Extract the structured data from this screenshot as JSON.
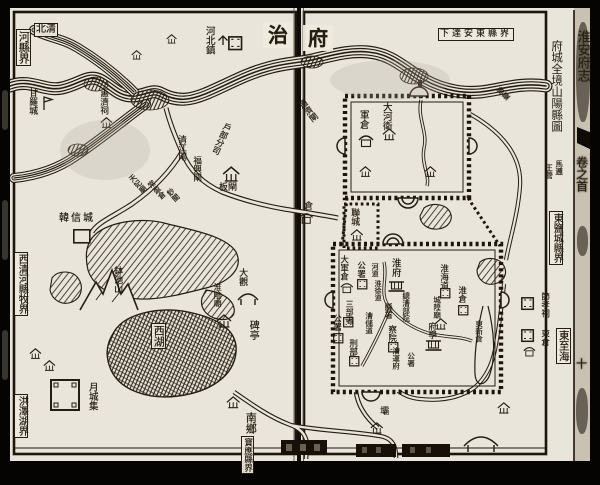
{
  "book": {
    "title": "淮安府志",
    "volume": "卷之首",
    "page_mark": "十"
  },
  "map": {
    "title": "府城全境山陽縣圖",
    "prefecture_seat": {
      "right_page_char": "府",
      "left_page_char": "治"
    },
    "labels": [
      {
        "t": "北清",
        "x": 34,
        "y": 23,
        "o": "h",
        "fs": 10,
        "box": 1,
        "name": "border-north-label-top"
      },
      {
        "t": "河縣界",
        "x": 16,
        "y": 29,
        "o": "v",
        "fs": 11,
        "box": 1,
        "name": "border-north-label"
      },
      {
        "t": "甘羅城",
        "x": 27,
        "y": 88,
        "o": "v",
        "fs": 9,
        "name": "ganluocheng-label"
      },
      {
        "t": "惠濟祠",
        "x": 99,
        "y": 89,
        "o": "v",
        "fs": 8.5,
        "name": "huijici-label"
      },
      {
        "t": "河北鎮",
        "x": 204,
        "y": 26,
        "o": "v",
        "fs": 9.5,
        "name": "hebeizhen-label"
      },
      {
        "t": "治",
        "x": 263,
        "y": 22,
        "o": "h",
        "fs": 20,
        "seat": 1,
        "name": "seat-zhi-label"
      },
      {
        "t": "府",
        "x": 303,
        "y": 25,
        "o": "h",
        "fs": 20,
        "seat": 1,
        "name": "seat-fu-label"
      },
      {
        "t": "下達安東縣界",
        "x": 438,
        "y": 28,
        "o": "h",
        "fs": 9,
        "box": 1,
        "ls": 3,
        "name": "andong-border-label"
      },
      {
        "t": "通濟閘",
        "x": 296,
        "y": 104,
        "o": "v",
        "fs": 8.5,
        "rot": -38,
        "name": "tongjizha-label"
      },
      {
        "t": "清江閘",
        "x": 177,
        "y": 135,
        "o": "v",
        "fs": 8.5,
        "name": "qingjiangzha-label"
      },
      {
        "t": "福興閘",
        "x": 192,
        "y": 156,
        "o": "v",
        "fs": 8.5,
        "name": "fuxingzha-label"
      },
      {
        "t": "戶部分司",
        "x": 224,
        "y": 121,
        "o": "v",
        "fs": 8.5,
        "rot": 25,
        "name": "hubu-fensi-label"
      },
      {
        "t": "板閘",
        "x": 219,
        "y": 184,
        "o": "h",
        "fs": 9,
        "name": "banzha-label"
      },
      {
        "t": "天妃廟",
        "x": 127,
        "y": 178,
        "o": "v",
        "fs": 7.5,
        "rot": -42,
        "name": "tianfeimiao-label"
      },
      {
        "t": "常盈倉",
        "x": 146,
        "y": 184,
        "o": "v",
        "fs": 7.5,
        "rot": -42,
        "name": "changyingcang-label"
      },
      {
        "t": "鈔關",
        "x": 165,
        "y": 192,
        "o": "v",
        "fs": 7.5,
        "rot": -42,
        "name": "chaoguan-label"
      },
      {
        "t": "韓信城",
        "x": 59,
        "y": 214,
        "o": "h",
        "fs": 10,
        "ls": 2,
        "name": "hanxincheng-label"
      },
      {
        "t": "鉢池山",
        "x": 112,
        "y": 266,
        "o": "v",
        "fs": 9,
        "name": "bochishan-label"
      },
      {
        "t": "淮陰廟",
        "x": 213,
        "y": 283,
        "o": "v",
        "fs": 8,
        "name": "huaiyinmiao-label"
      },
      {
        "t": "大觀",
        "x": 237,
        "y": 268,
        "o": "v",
        "fs": 9,
        "name": "daguan-label"
      },
      {
        "t": "碑亭",
        "x": 247,
        "y": 320,
        "o": "v",
        "fs": 10,
        "name": "beiting-label"
      },
      {
        "t": "西湖",
        "x": 151,
        "y": 323,
        "o": "v",
        "fs": 11,
        "box": 1,
        "name": "xihu-label"
      },
      {
        "t": "南鄉",
        "x": 245,
        "y": 412,
        "o": "v",
        "fs": 11,
        "name": "nanxiang-label"
      },
      {
        "t": "月城集",
        "x": 87,
        "y": 382,
        "o": "v",
        "fs": 9.5,
        "name": "yuechengji-label"
      },
      {
        "t": "寶應縣界",
        "x": 241,
        "y": 436,
        "o": "v",
        "fs": 8.5,
        "box": 1,
        "name": "baoying-border-label"
      },
      {
        "t": "西清河縣牧界",
        "x": 14,
        "y": 252,
        "o": "v",
        "fs": 10,
        "box": 1,
        "name": "border-west-label"
      },
      {
        "t": "洪澤湖界",
        "x": 14,
        "y": 394,
        "o": "v",
        "fs": 10,
        "box": 1,
        "name": "border-southwest-label"
      },
      {
        "t": "墩臺",
        "x": 495,
        "y": 91,
        "o": "v",
        "fs": 7.5,
        "rot": -45,
        "name": "duntai-label"
      },
      {
        "t": "王營",
        "x": 545,
        "y": 164,
        "o": "v",
        "fs": 7.5,
        "name": "wangying-label"
      },
      {
        "t": "馬邏",
        "x": 555,
        "y": 160,
        "o": "v",
        "fs": 7.5,
        "name": "maluo-label"
      },
      {
        "t": "軍倉",
        "x": 358,
        "y": 110,
        "o": "v",
        "fs": 9.5,
        "name": "juncang-label"
      },
      {
        "t": "大河衛",
        "x": 381,
        "y": 102,
        "o": "v",
        "fs": 9.5,
        "name": "dahewei-label"
      },
      {
        "t": "聯城",
        "x": 349,
        "y": 208,
        "o": "v",
        "fs": 9,
        "name": "liancheng-label"
      },
      {
        "t": "倉",
        "x": 302,
        "y": 201,
        "o": "v",
        "fs": 9,
        "name": "west-cang-label"
      },
      {
        "t": "淮府",
        "x": 390,
        "y": 258,
        "o": "v",
        "fs": 9.5,
        "name": "huaifu-label"
      },
      {
        "t": "大軍倉",
        "x": 339,
        "y": 255,
        "o": "v",
        "fs": 8.5,
        "name": "dajuncang-label"
      },
      {
        "t": "公署",
        "x": 356,
        "y": 261,
        "o": "v",
        "fs": 8.5,
        "name": "gongshu-label-1"
      },
      {
        "t": "河道",
        "x": 371,
        "y": 263,
        "o": "v",
        "fs": 7,
        "name": "hedao-label"
      },
      {
        "t": "淮徐道",
        "x": 374,
        "y": 280,
        "o": "v",
        "fs": 7,
        "name": "huaixudao-label"
      },
      {
        "t": "三部署",
        "x": 345,
        "y": 300,
        "o": "v",
        "fs": 8,
        "name": "sanbushu-label"
      },
      {
        "t": "公署",
        "x": 332,
        "y": 314,
        "o": "v",
        "fs": 8.5,
        "name": "gongshu-label-2"
      },
      {
        "t": "漕儲道",
        "x": 365,
        "y": 312,
        "o": "v",
        "fs": 7.5,
        "name": "caochudao-label"
      },
      {
        "t": "刑部",
        "x": 348,
        "y": 339,
        "o": "v",
        "fs": 8.5,
        "name": "xingbu-label"
      },
      {
        "t": "縣署",
        "x": 384,
        "y": 303,
        "o": "v",
        "fs": 8,
        "name": "xianshu-label"
      },
      {
        "t": "總漕部院",
        "x": 402,
        "y": 292,
        "o": "v",
        "fs": 7.5,
        "name": "zongcao-buyuan-label"
      },
      {
        "t": "察院",
        "x": 387,
        "y": 325,
        "o": "v",
        "fs": 8.5,
        "name": "chayuan-label"
      },
      {
        "t": "漕運府",
        "x": 392,
        "y": 347,
        "o": "v",
        "fs": 7.5,
        "name": "caoyunfu-label"
      },
      {
        "t": "公署",
        "x": 407,
        "y": 352,
        "o": "v",
        "fs": 7.5,
        "name": "gongshu-label-3"
      },
      {
        "t": "淮海道",
        "x": 439,
        "y": 264,
        "o": "v",
        "fs": 8.5,
        "name": "huaihaidao-label"
      },
      {
        "t": "城隍廟",
        "x": 433,
        "y": 296,
        "o": "v",
        "fs": 7.5,
        "name": "chenghuangmiao-label"
      },
      {
        "t": "淮倉",
        "x": 457,
        "y": 286,
        "o": "v",
        "fs": 8.5,
        "name": "huaicang-label"
      },
      {
        "t": "東新倉",
        "x": 475,
        "y": 320,
        "o": "v",
        "fs": 7.5,
        "name": "dongxincang-label"
      },
      {
        "t": "府學",
        "x": 427,
        "y": 322,
        "o": "v",
        "fs": 8.5,
        "name": "fuxue-label"
      },
      {
        "t": "節孝祠",
        "x": 540,
        "y": 292,
        "o": "v",
        "fs": 8.5,
        "name": "jiexiaoci-label"
      },
      {
        "t": "東倉",
        "x": 540,
        "y": 329,
        "o": "v",
        "fs": 8.5,
        "name": "dongcang-label"
      },
      {
        "t": "東至海",
        "x": 556,
        "y": 328,
        "o": "v",
        "fs": 10.5,
        "box": 1,
        "name": "east-to-sea-label"
      },
      {
        "t": "東鹽城縣界",
        "x": 549,
        "y": 211,
        "o": "v",
        "fs": 10,
        "box": 1,
        "name": "border-east-label"
      },
      {
        "t": "壩",
        "x": 378,
        "y": 406,
        "o": "v",
        "fs": 9,
        "name": "ba-label"
      }
    ],
    "icons": [
      {
        "type": "flag",
        "x": 42,
        "y": 95,
        "name": "ganluocheng-flag-icon"
      },
      {
        "type": "house",
        "x": 100,
        "y": 117,
        "s": 0.8,
        "name": "huijici-house-icon"
      },
      {
        "type": "tree",
        "x": 217,
        "y": 32,
        "name": "hebeizhen-tree-icon"
      },
      {
        "type": "box",
        "x": 228,
        "y": 36,
        "s": 1.1,
        "name": "hebeizhen-box-icon"
      },
      {
        "type": "house",
        "x": 166,
        "y": 34,
        "s": 0.7,
        "name": "river-north-house-icon"
      },
      {
        "type": "house",
        "x": 131,
        "y": 50,
        "s": 0.7,
        "name": "river-north-house-icon-2"
      },
      {
        "type": "house",
        "x": 222,
        "y": 166,
        "s": 1.15,
        "name": "hubu-fensi-office-icon"
      },
      {
        "type": "sq",
        "x": 73,
        "y": 229,
        "name": "hanxincheng-square-icon"
      },
      {
        "type": "house",
        "x": 216,
        "y": 314,
        "name": "huaiyinmiao-temple-icon"
      },
      {
        "type": "bigbox",
        "x": 50,
        "y": 379,
        "name": "yuechengji-fort-icon"
      },
      {
        "type": "house",
        "x": 226,
        "y": 396,
        "s": 0.9,
        "name": "nanxiang-house-icon"
      },
      {
        "type": "gran",
        "x": 358,
        "y": 134,
        "name": "juncang-granary-icon"
      },
      {
        "type": "house",
        "x": 382,
        "y": 128,
        "s": 0.9,
        "name": "dahewei-house-icon"
      },
      {
        "type": "house",
        "x": 359,
        "y": 166,
        "s": 0.8,
        "name": "xincheng-house-icon"
      },
      {
        "type": "house",
        "x": 424,
        "y": 166,
        "s": 0.8,
        "name": "xincheng-house-icon-2"
      },
      {
        "type": "house",
        "x": 350,
        "y": 229,
        "s": 0.85,
        "name": "liancheng-house-icon"
      },
      {
        "type": "gran",
        "x": 299,
        "y": 212,
        "s": 0.9,
        "name": "west-granary-icon"
      },
      {
        "type": "yamen",
        "x": 389,
        "y": 280,
        "name": "huaifu-yamen-icon"
      },
      {
        "type": "gran",
        "x": 340,
        "y": 282,
        "s": 0.85,
        "name": "dajuncang-granary-icon"
      },
      {
        "type": "box",
        "x": 357,
        "y": 279,
        "s": 0.8,
        "name": "gongshu-box-icon"
      },
      {
        "type": "box",
        "x": 343,
        "y": 317,
        "s": 0.8,
        "name": "sanbushu-box-icon"
      },
      {
        "type": "box",
        "x": 333,
        "y": 333,
        "s": 0.8,
        "name": "gongshu2-box-icon"
      },
      {
        "type": "box",
        "x": 349,
        "y": 356,
        "s": 0.8,
        "name": "xingbu-box-icon"
      },
      {
        "type": "box",
        "x": 388,
        "y": 342,
        "s": 0.8,
        "name": "chayuan-box-icon"
      },
      {
        "type": "box",
        "x": 440,
        "y": 288,
        "s": 0.8,
        "name": "huaihaidao-box-icon"
      },
      {
        "type": "house",
        "x": 434,
        "y": 318,
        "s": 0.85,
        "name": "chenghuangmiao-temple-icon"
      },
      {
        "type": "box",
        "x": 458,
        "y": 305,
        "s": 0.8,
        "name": "huaicang-box-icon"
      },
      {
        "type": "yamen",
        "x": 426,
        "y": 339,
        "name": "fuxue-temple-icon"
      },
      {
        "type": "box",
        "x": 521,
        "y": 297,
        "name": "jiexiaoci-box-icon"
      },
      {
        "type": "box",
        "x": 521,
        "y": 329,
        "name": "dongcang-box-icon"
      },
      {
        "type": "gran",
        "x": 523,
        "y": 346,
        "s": 0.8,
        "name": "dongcang-granary-icon"
      },
      {
        "type": "house",
        "x": 370,
        "y": 422,
        "s": 0.85,
        "name": "ba-house-icon"
      },
      {
        "type": "house",
        "x": 497,
        "y": 402,
        "s": 0.85,
        "name": "se-house-icon"
      },
      {
        "type": "house",
        "x": 29,
        "y": 348,
        "s": 0.8,
        "name": "sw-house-icon"
      },
      {
        "type": "house",
        "x": 43,
        "y": 360,
        "s": 0.8,
        "name": "sw-house-icon-2"
      }
    ]
  },
  "colors": {
    "paper": "#e9e5da",
    "ink": "#241d12"
  }
}
